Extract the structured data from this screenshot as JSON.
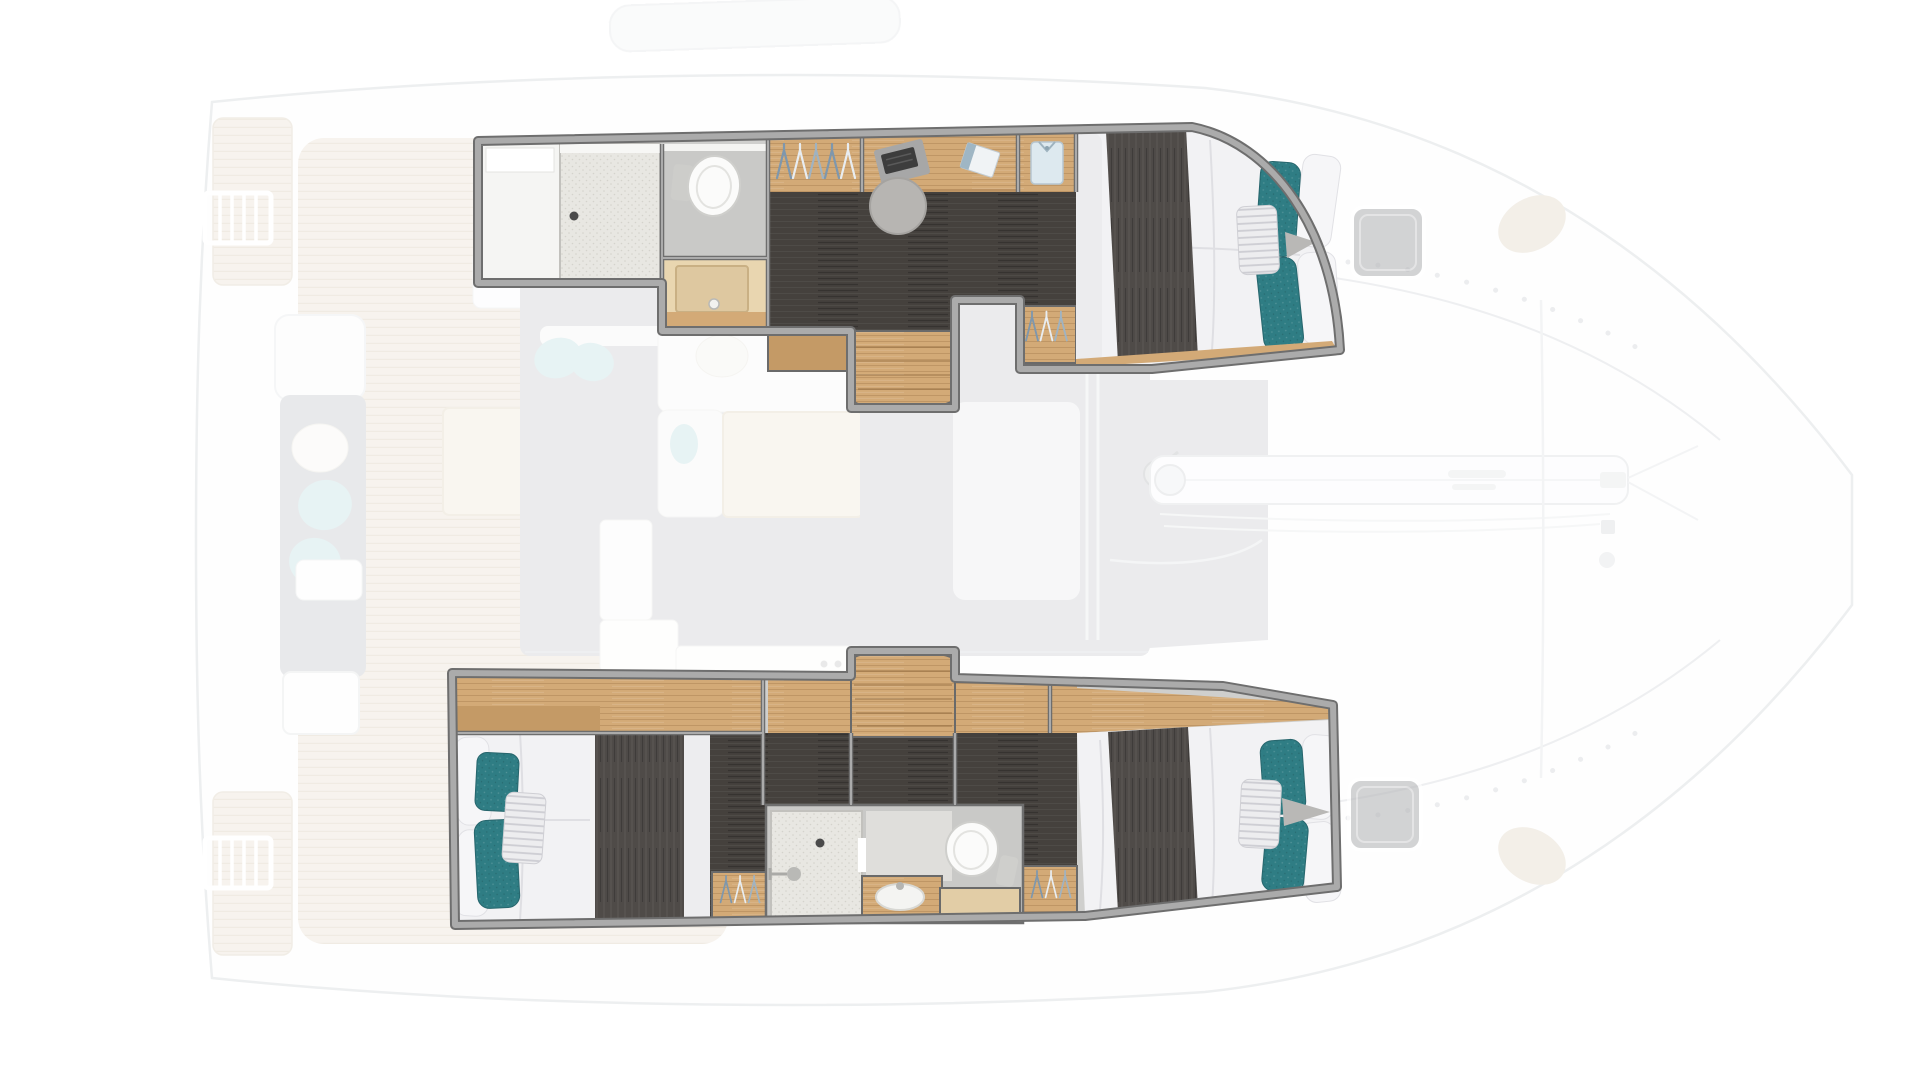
{
  "title": "Catamaran interior floor plan, top-down view",
  "colors": {
    "background": "#ffffff",
    "faded_opacity": "0.4",
    "hull_line": "#d3d6d9",
    "hull_fill": "#fcfcfd",
    "deck_wood": "#eae2d4",
    "deck_wood_line": "#d9cdba",
    "cabin_border": "#6e6e6e",
    "cabin_border_light": "#ababab",
    "wood": "#d3aa77",
    "wood_dark": "#c49a66",
    "counter": "#e9d6b0",
    "dark_floor": "#45413d",
    "runner": "#4f4b48",
    "mattress": "#f2f2f4",
    "pillow_white": "#f6f6f8",
    "pillow_stripe": "#ededef",
    "teal": "#2f7d84",
    "room_gray": "#c9c9c7",
    "shower_tray": "#e8e7e2",
    "fixture_white": "#fbfbfa",
    "hatch_gray": "#b7b8ba",
    "sofa_gray": "#c6c9cc",
    "sofa_white": "#fafafa",
    "cushion_blue": "#c2e0e4",
    "table_beige": "#efe8da",
    "saloon_floor": "#ccced1",
    "chair_gray": "#b7b5b2",
    "shirt_blue": "#dde9ef"
  },
  "plan": {
    "view": "top-down",
    "highlighted_cabins": [
      {
        "id": "port-hull-cabin",
        "fixtures": [
          "locker",
          "shower",
          "toilet",
          "vanity-sink",
          "hanging-locker",
          "desk",
          "laptop",
          "notebook",
          "chair",
          "shirt-shelf",
          "companionway-stairs",
          "double-berth",
          "teal-pillows",
          "striped-pillow"
        ]
      },
      {
        "id": "starboard-hull-cabin",
        "fixtures": [
          "double-berth-aft",
          "teal-pillows",
          "striped-pillow",
          "companionway-stairs",
          "shower",
          "vanity-sink",
          "toilet",
          "hanging-locker",
          "double-berth-fwd"
        ]
      }
    ],
    "faded_areas": [
      "swim-platforms",
      "ladders",
      "aft-cockpit",
      "cockpit-sofa",
      "cockpit-table",
      "helm-seat",
      "saloon-sofa",
      "saloon-table",
      "galley",
      "foredeck",
      "mast-base",
      "forward-crossbeam",
      "trampoline",
      "deck-hatches",
      "boom"
    ],
    "deck_hatches": 2,
    "swim_ladders": 2
  }
}
